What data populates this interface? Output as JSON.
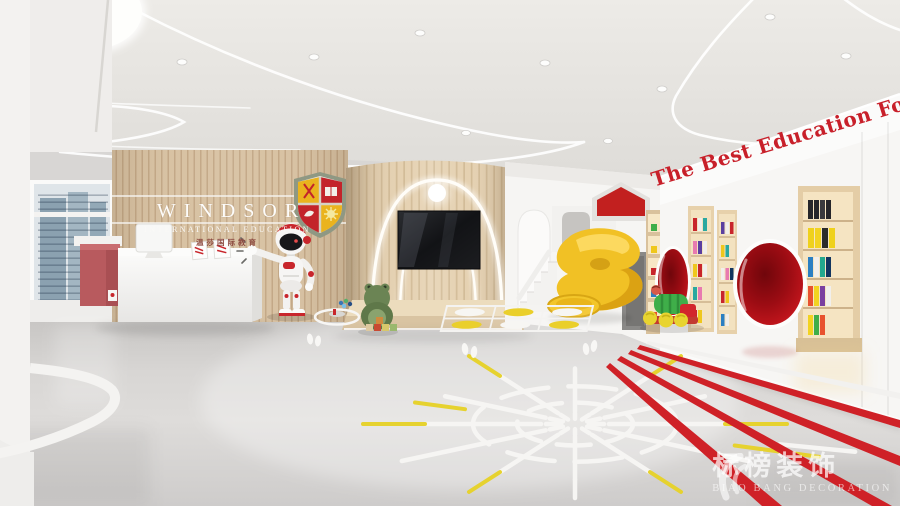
{
  "scene": {
    "description": "3D render of a kindergarten lobby: reception desk, mascot robot, wooden stage with TV, spiral slide, reading wall with pod chairs, play-marked floor"
  },
  "reception_sign": {
    "brand": "WINDSOR",
    "subtitle": "INTERNATIONAL EDUCATION",
    "subtitle_cn": "温莎国际教育"
  },
  "right_wall": {
    "slogan": "The Best Education For C"
  },
  "watermark": {
    "brand_cn": "标榜装饰",
    "brand_en": "BIAO BANG DECORATION"
  },
  "objects": [
    "reception-desk",
    "mascot-robot",
    "school-crest",
    "tv-screen",
    "stage",
    "spiral-slide",
    "staircase",
    "bookshelves",
    "pod-chairs",
    "toy-train",
    "frog-plush",
    "hopscotch-mat",
    "floor-compass",
    "running-track"
  ],
  "colors": {
    "accent_red": "#c8202a",
    "slide_yellow": "#f1c125",
    "wood": "#d8c2a3",
    "floor_grey": "#d6d4d2",
    "ceiling_grey": "#e5e3df",
    "track_red": "#cf2127",
    "marking_yellow": "#e6d22f",
    "marking_white": "#f6f5f3"
  }
}
